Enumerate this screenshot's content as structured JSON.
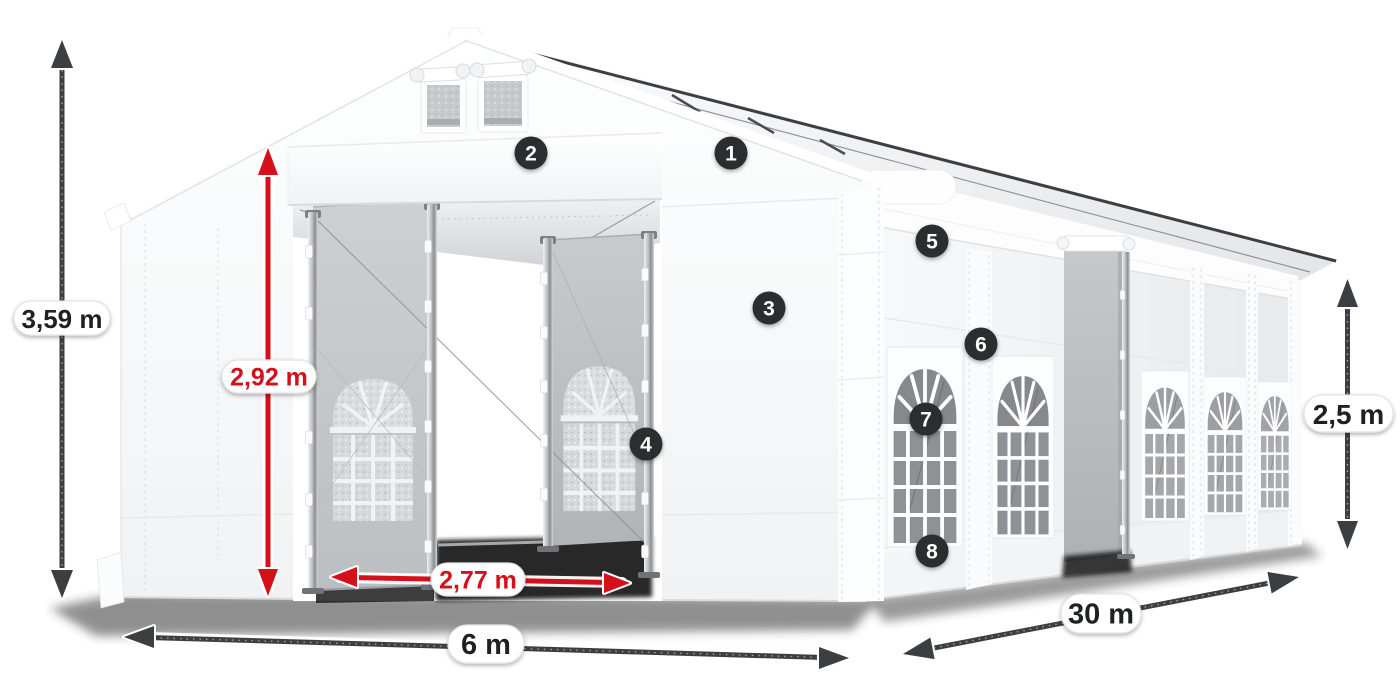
{
  "figure": {
    "alt": "White marquee party tent shown in perspective with dimension arrows and numbered feature callouts"
  },
  "dimensions": {
    "total_height": "3,59 m",
    "entrance_height": "2,92 m",
    "entrance_width": "2,77 m",
    "front_width": "6 m",
    "side_length": "30 m",
    "side_wall_height": "2,5 m"
  },
  "callouts": [
    "1",
    "2",
    "3",
    "4",
    "5",
    "6",
    "7",
    "8"
  ],
  "colors": {
    "accent_red": "#d4111b",
    "arrow_dark": "#3c3f42",
    "label_text": "#1f2022",
    "badge_background": "#2c2d2f",
    "badge_text": "#ffffff",
    "tent_white": "#f4f5f6",
    "glass_gray": "#85898d"
  }
}
